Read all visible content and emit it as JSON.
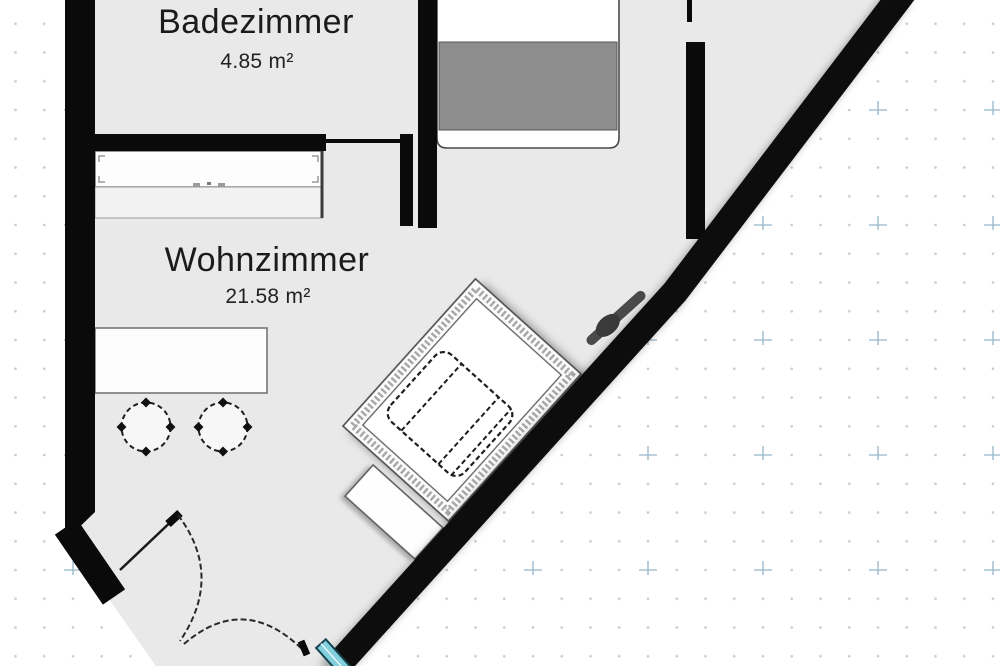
{
  "floorplan": {
    "rooms": [
      {
        "name": "Badezimmer",
        "area": "4.85 m²"
      },
      {
        "name": "Wohnzimmer",
        "area": "21.58 m²"
      }
    ],
    "furniture_symbols": [
      "bed",
      "wardrobe",
      "dining-table",
      "round-chair",
      "round-chair",
      "rug",
      "armchair",
      "sideboard",
      "door-swing",
      "door-swing",
      "window",
      "wall-handle"
    ],
    "colors": {
      "floor": "#e9e9ea",
      "wall": "#0a0a0a",
      "bed_blanket": "#8d8d8d",
      "window_fill": "#82cfdd",
      "window_frame": "#14424f",
      "grid_dot": "#c7cbd0",
      "grid_cross": "#a8c2d3",
      "label_text": "#1b1b1b"
    }
  }
}
